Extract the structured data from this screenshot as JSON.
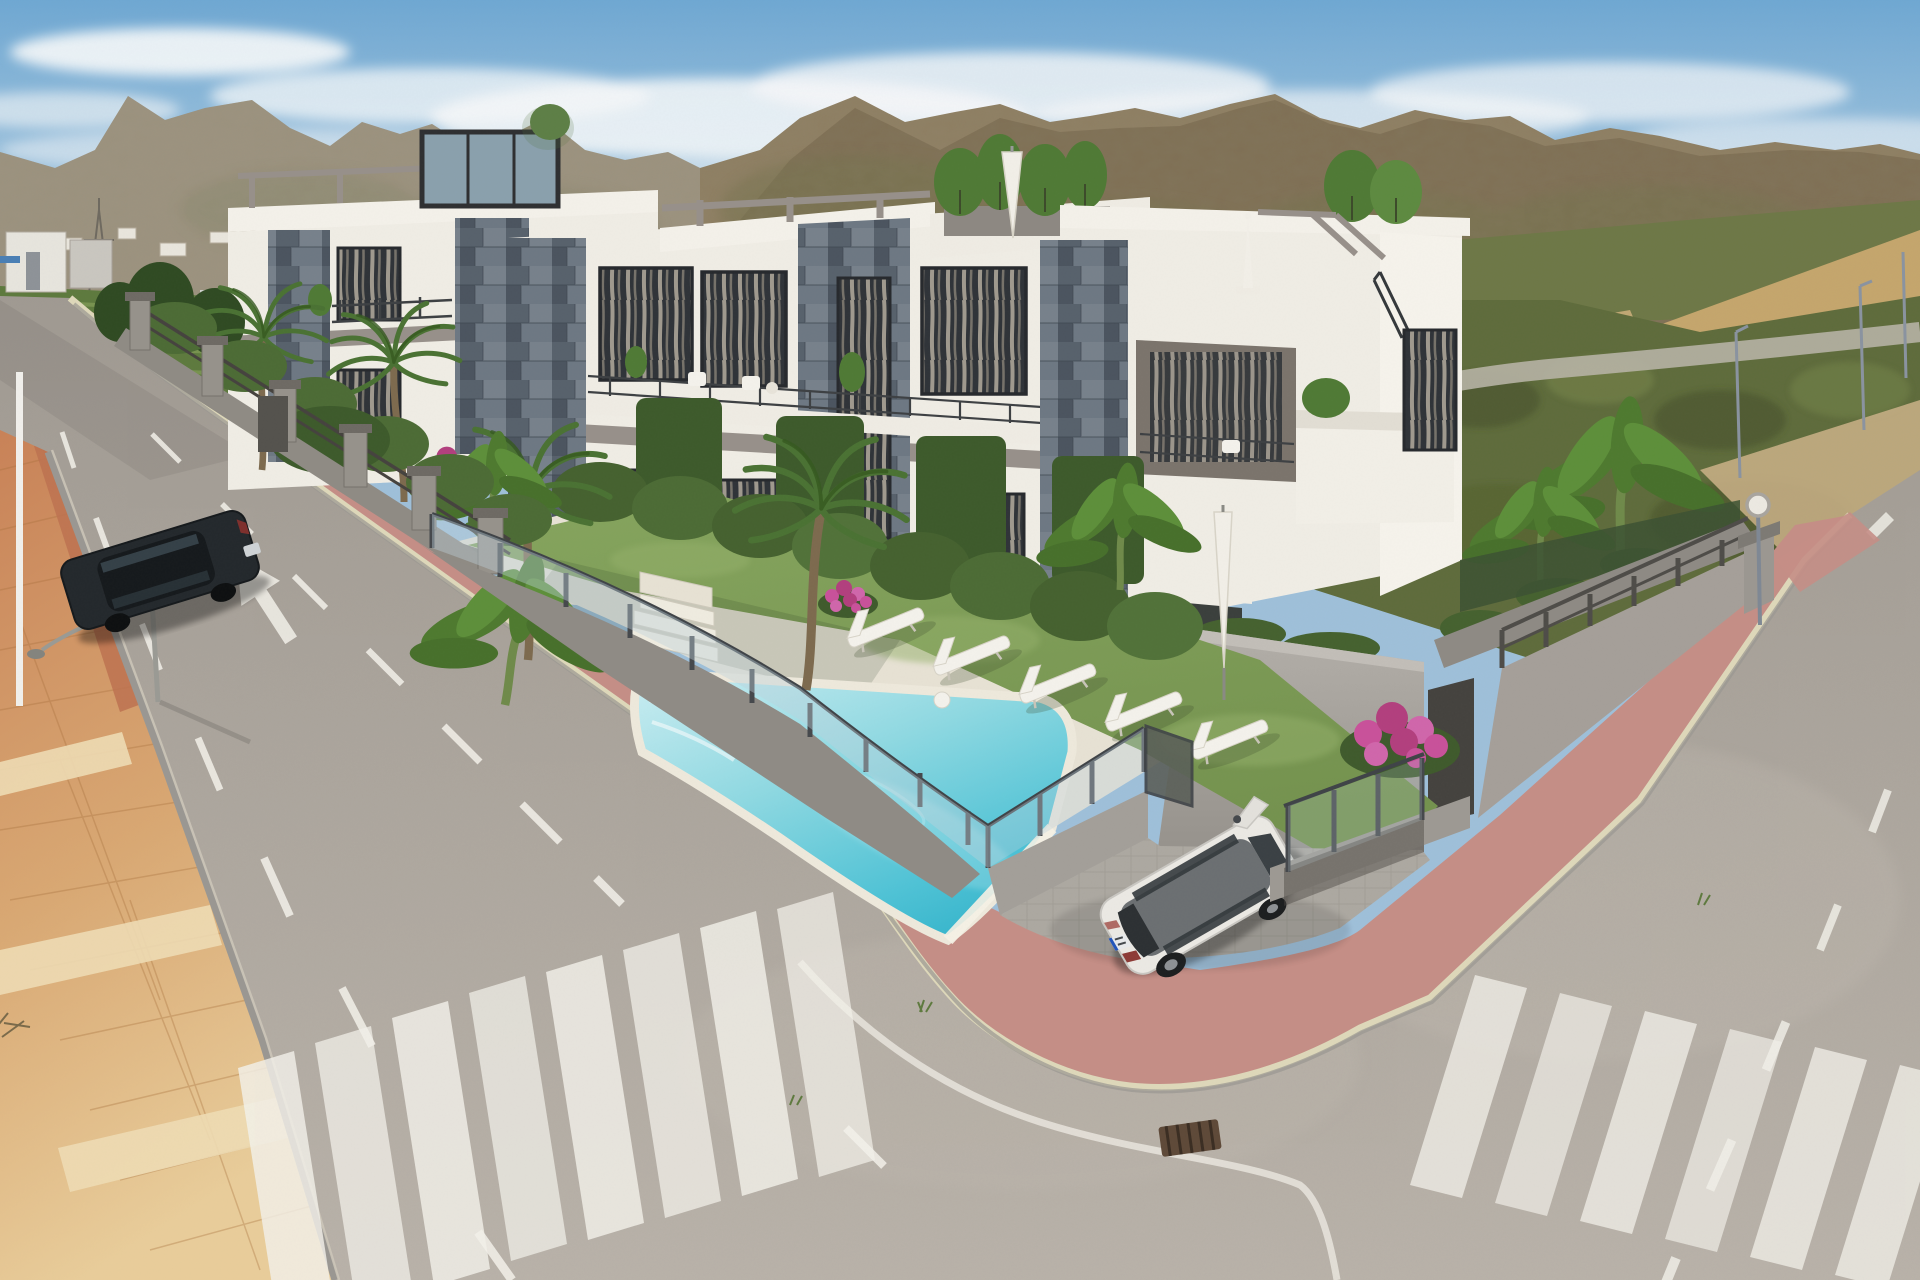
{
  "scene": {
    "type": "architectural-render",
    "view": "aerial three-quarter view",
    "setting": "modern residential complex on a street corner with communal pool, gardens, two asphalt streets with zebra crossings, mountain and scrubland backdrop",
    "lighting": "sunny midday, scattered clouds"
  },
  "colors": {
    "sky_top": "#6fa8d3",
    "sky_horizon": "#e3ebef",
    "cloud": "#f6f8f9",
    "mountain_base": "#8f7f63",
    "mountain_dark": "#6f6247",
    "mountain_olive": "#77744f",
    "field_green": "#5e7a3e",
    "field_light": "#7f9a55",
    "village_white": "#e9e6dd",
    "scrub_green": "#5f6c3c",
    "scrub_dark": "#47532c",
    "scrub_light": "#76854c",
    "cliff_tan": "#c5a66d",
    "back_road": "#b6b2a4",
    "asphalt": "#aaa49c",
    "asphalt_light": "#beb7ad",
    "marking": "#f3f1ea",
    "terracotta": "#cf9468",
    "terracotta_red": "#bd7250",
    "sidewalk_tan": "#e6c795",
    "tactile_light": "#eedcb4",
    "sidewalk_pink": "#c58e86",
    "curb_cream": "#ded8ba",
    "curbstone": "#9a9792",
    "wall_gray": "#a19d97",
    "wall_shadow": "#8b8781",
    "wall_light": "#b5b1ab",
    "fence_dark": "#4e4c48",
    "glass_blue": "#bdd1dc",
    "building_white": "#f0ede5",
    "building_cream": "#e5e1d7",
    "beam_gray": "#97908a",
    "window_dark": "#2f3338",
    "curtain": "#cfc5b2",
    "hedge": "#45612f",
    "hedge_light": "#5a7a3e",
    "grass": "#7d9b57",
    "pool_deep": "#3db4cb",
    "pool_pale": "#c6ecf1",
    "deck_cream": "#e7e2d4",
    "lounger": "#f4f2ec",
    "flower_pink": "#c9519a",
    "flower_orange": "#d98f3d",
    "palm_green": "#4a7233",
    "trunk_brown": "#8a7354",
    "car_white": "#ebe9e4",
    "car_dark": "#23282c",
    "plate_blue": "#2255bb",
    "drain_brown": "#5e4938"
  },
  "objects": {
    "buildings": {
      "count": 3,
      "style": "white render with blue-grey slate tile towers, flat roofs, roof terraces with planters and pergolas"
    },
    "pool": {
      "count": 1,
      "fence": "glass panels with dark posts"
    },
    "sun_loungers": 5,
    "roof_loungers": 2,
    "parasols": 2,
    "palm_trees": 4,
    "banana_plants": 4,
    "flower_bushes": 4,
    "cars": [
      {
        "color": "dark navy",
        "type": "estate",
        "location": "parked on left street"
      },
      {
        "color": "pearl white",
        "type": "compact MPV",
        "location": "driveway at the corner"
      }
    ],
    "crosswalks": 2,
    "crosswalk_stripes": [
      8,
      6
    ],
    "road_arrows": 1,
    "traffic_signs": 1,
    "street_lamps": 3,
    "power_pylons": 2,
    "drain_grates": 1
  }
}
